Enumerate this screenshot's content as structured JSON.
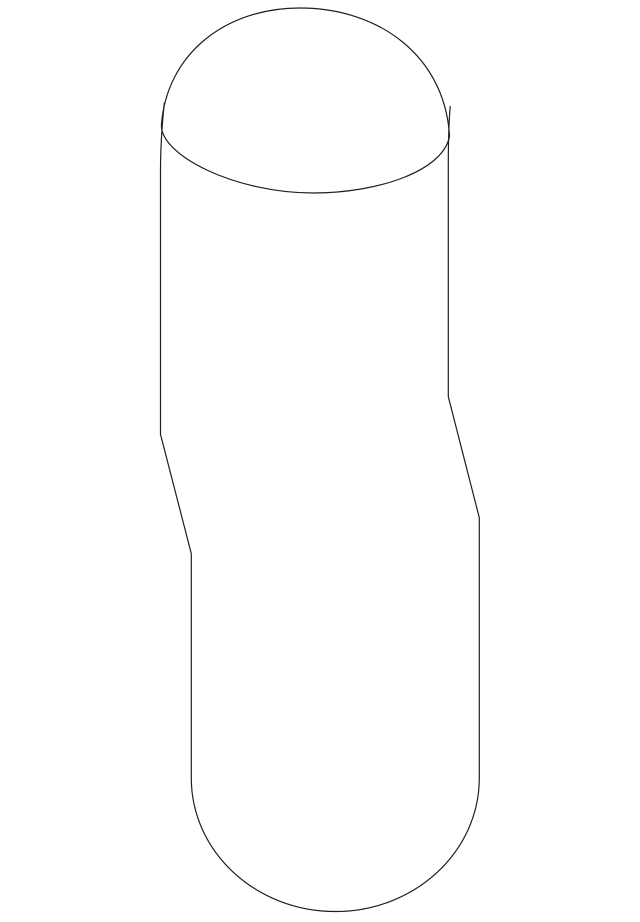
{
  "page": {
    "background_color": "#ffffff",
    "width_px": 640,
    "height_px": 922
  },
  "diagram": {
    "name": "part-outline-line-drawing",
    "description": "Single-weight black outline drawing of a tall rounded part shown on a blank white background: an egg-shaped ellipse forms the open top, two near-vertical side lines cross the ellipse leaving short tails, both sides step diagonally to the right at mid-height, and the body ends in a deep U-shaped rounded bottom.",
    "stroke_color": "#1f1f1f",
    "stroke_width": 1.2,
    "fill": "none",
    "viewbox": "0 0 640 922",
    "paths": {
      "body_outline": "M 164.3,103 C 162,125 160.5,148 160.5,170 L 160.5,434.3 L 191.3,553.7 L 191.3,778 C 191.3,851.7 255.8,911.5 335.3,911.5 C 414.8,911.5 479.3,851.7 479.3,778 L 479.3,517.7 L 448.3,396.7 L 448.3,165 C 448.3,140 448.9,122 450.2,106.5",
      "top_opening_ellipse": "M 300,8 C 224,8 167,55 161.5,124 C 159,155 235,193 313,193 C 380,193 444,170 449.5,136 C 445,57 380,8 300,8 Z"
    }
  }
}
